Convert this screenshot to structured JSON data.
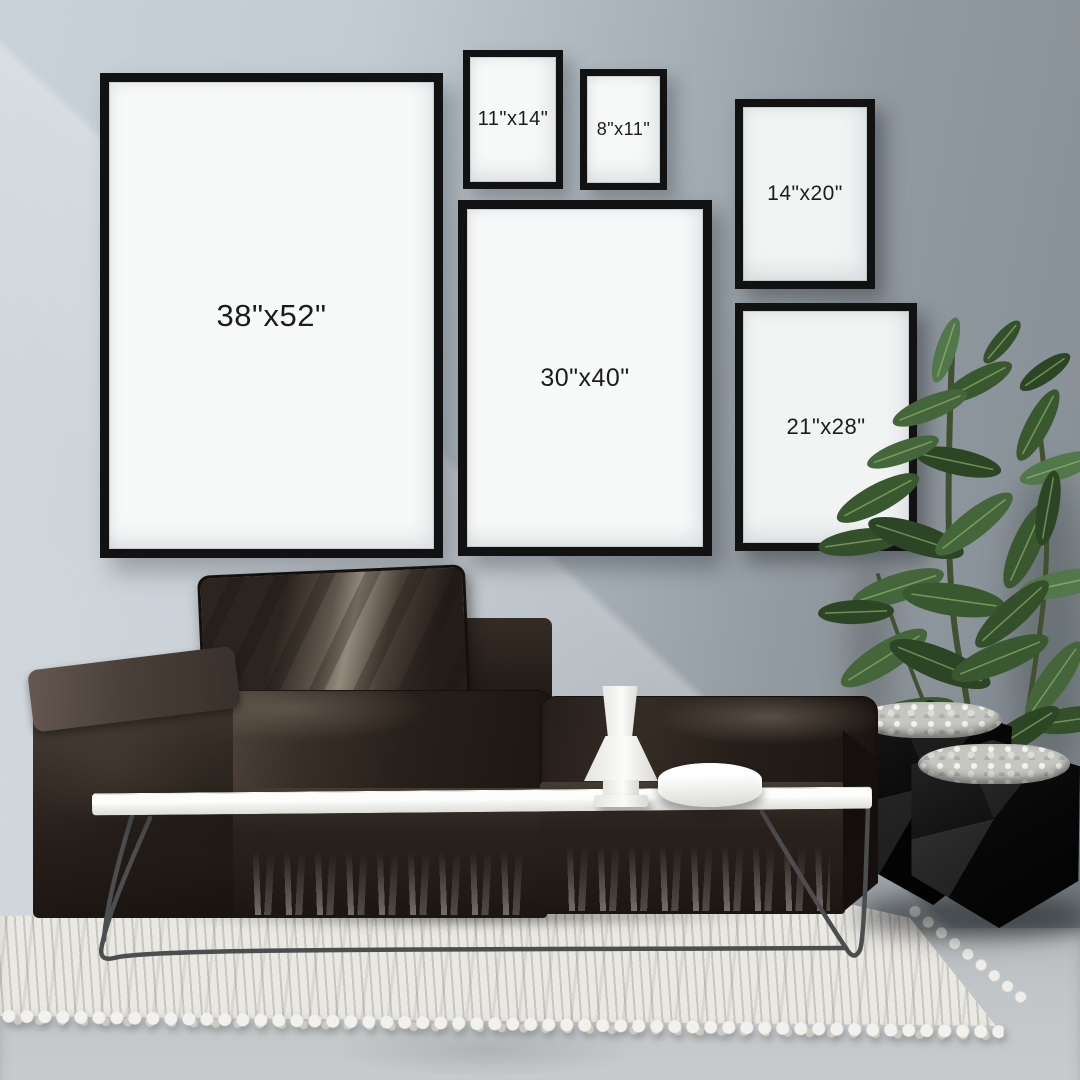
{
  "frames": [
    {
      "id": "frame-38x52",
      "label": "38\"x52\""
    },
    {
      "id": "frame-11x14",
      "label": "11\"x14\""
    },
    {
      "id": "frame-8x11",
      "label": "8\"x11\""
    },
    {
      "id": "frame-14x20",
      "label": "14\"x20\""
    },
    {
      "id": "frame-30x40",
      "label": "30\"x40\""
    },
    {
      "id": "frame-21x28",
      "label": "21\"x28\""
    }
  ],
  "colors": {
    "wall_left": "#c9d2d8",
    "wall_right": "#868e95",
    "frame_border": "#121212",
    "mat_bright": "#f8f9f9",
    "mat_dim": "#f2f4f4",
    "label": "#1c1c1c",
    "sofa_base": "#251d19",
    "sofa_sheen": "#948a7d",
    "table_top": "#f0f0ed",
    "leg_metal": "#4b4d4f",
    "vase_white": "#fbfbfa",
    "rug_base": "#eae8e3",
    "rug_rib": "#ccc9c2",
    "floor": "#c1c5c7",
    "plant_stem": "#41502e",
    "plant_green_1": "#2c4525",
    "plant_green_2": "#3a5830",
    "plant_green_3": "#44663a",
    "plant_green_4": "#52774a",
    "plant_green_5": "#33502b",
    "plant_vein": "#a9c97c",
    "planter_black": "#101010",
    "pebble": "#dcdcd8"
  }
}
